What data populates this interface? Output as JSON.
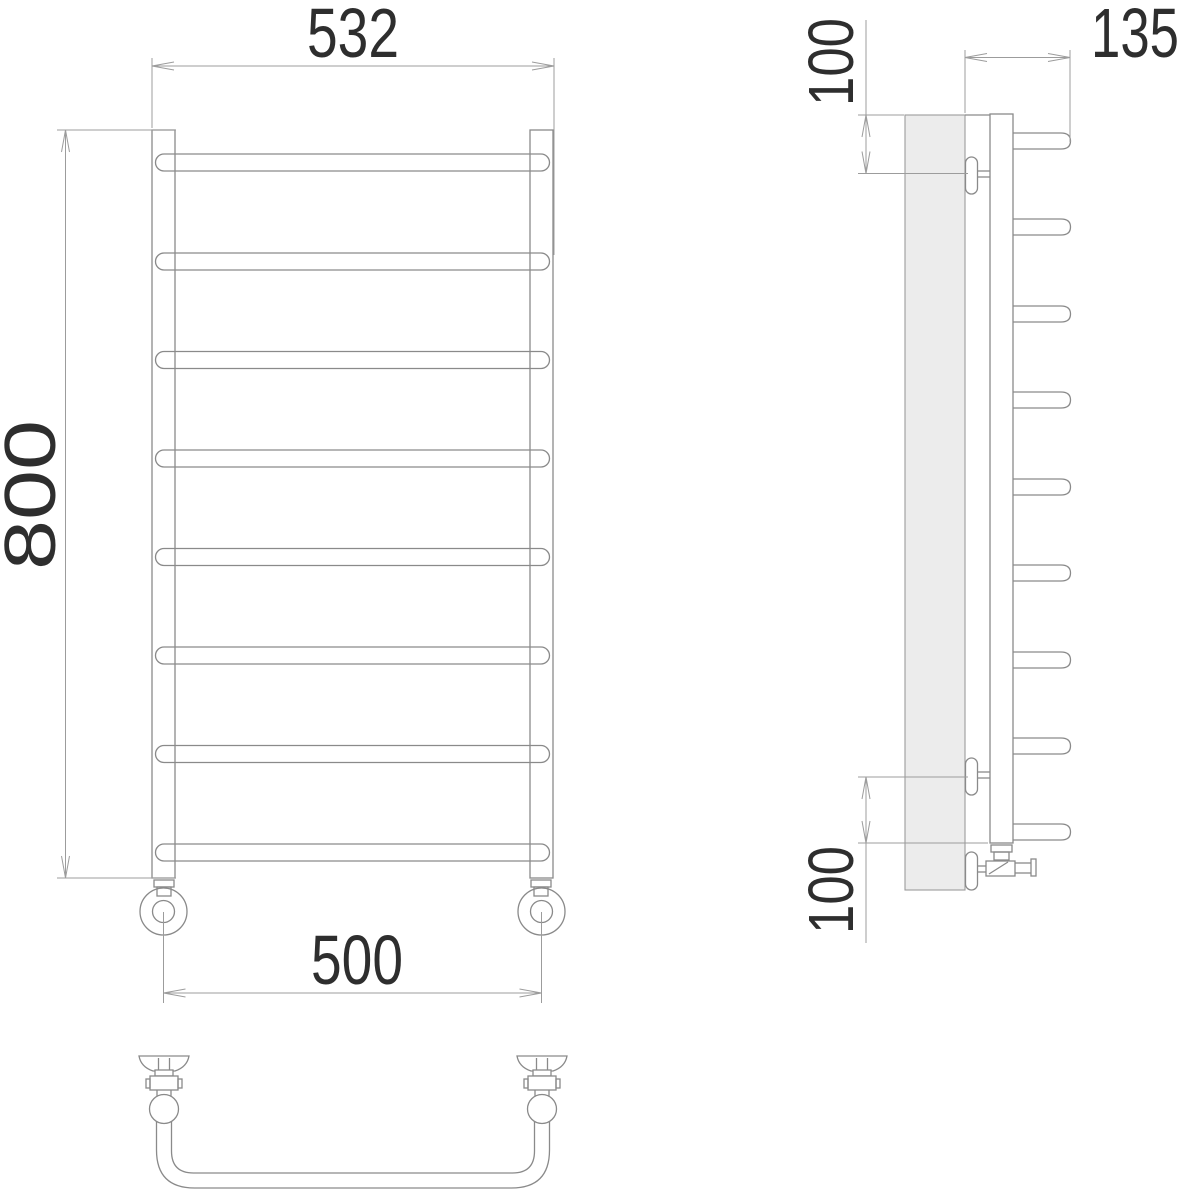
{
  "dimensions": {
    "front_overall_width": "532",
    "front_overall_height": "800",
    "front_bracket_spacing": "500",
    "side_depth": "135",
    "side_top_offset": "100",
    "side_bottom_offset": "100"
  },
  "structure": {
    "front_rung_count": 8,
    "side_stub_count": 9,
    "wall_bracket_count": 2,
    "views": [
      "front",
      "side",
      "bottom"
    ]
  },
  "colors": {
    "background": "#ffffff",
    "object_line": "#8a8a8a",
    "dimension_line": "#9c9c9c",
    "text": "#2e2e2e",
    "wall_fill": "#ececec"
  }
}
